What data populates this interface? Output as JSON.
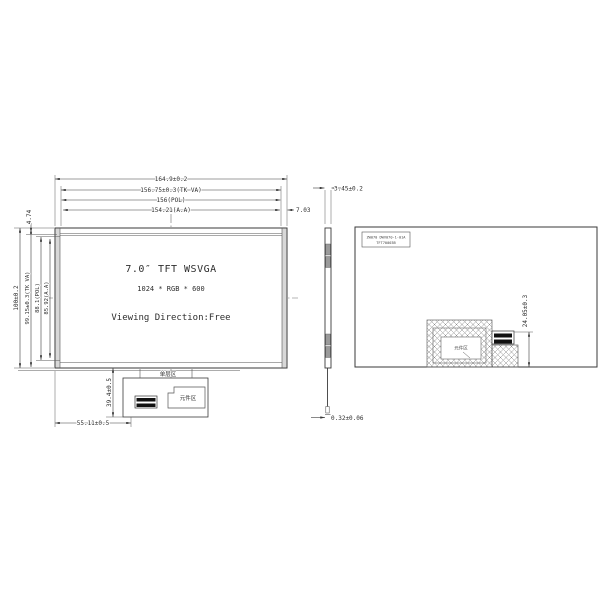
{
  "sheet": {
    "background": "#ffffff",
    "line_color": "#3a3a3a",
    "hatch_color": "#888888",
    "component_block_color": "#9a9a9a"
  },
  "front_view": {
    "title": "7.0″ TFT WSVGA",
    "resolution": "1024 * RGB * 600",
    "viewing_direction": "Viewing Direction:Free",
    "dims": {
      "width_outline": "164.9±0.2",
      "width_tk_va": "156.75±0.3(TK VA)",
      "width_pol": "156(POL)",
      "width_aa": "154.21(A.A)",
      "border_right": "7.03",
      "va_top_offset": "4.74",
      "height_outline": "100±0.2",
      "height_tk_va": "99.15±0.3(TK VA)",
      "height_pol": "88.1(POL)",
      "height_aa": "85.92(A.A)",
      "fpc_length": "39.4±0.5",
      "fpc_offset": "55.11±0.5"
    },
    "labels": {
      "single_layer_zone": "单层区",
      "component_zone": "元件区"
    }
  },
  "side_view": {
    "dims": {
      "thickness": "3.45±0.2",
      "fpc_thickness": "0.32±0.06"
    }
  },
  "back_view": {
    "part_label_line1": "ZW070 DWV070-1-01A",
    "part_label_line2": "TFT70003B",
    "component_zone": "元件区",
    "dims": {
      "fpc_fold_height": "24.05±0.3"
    }
  }
}
